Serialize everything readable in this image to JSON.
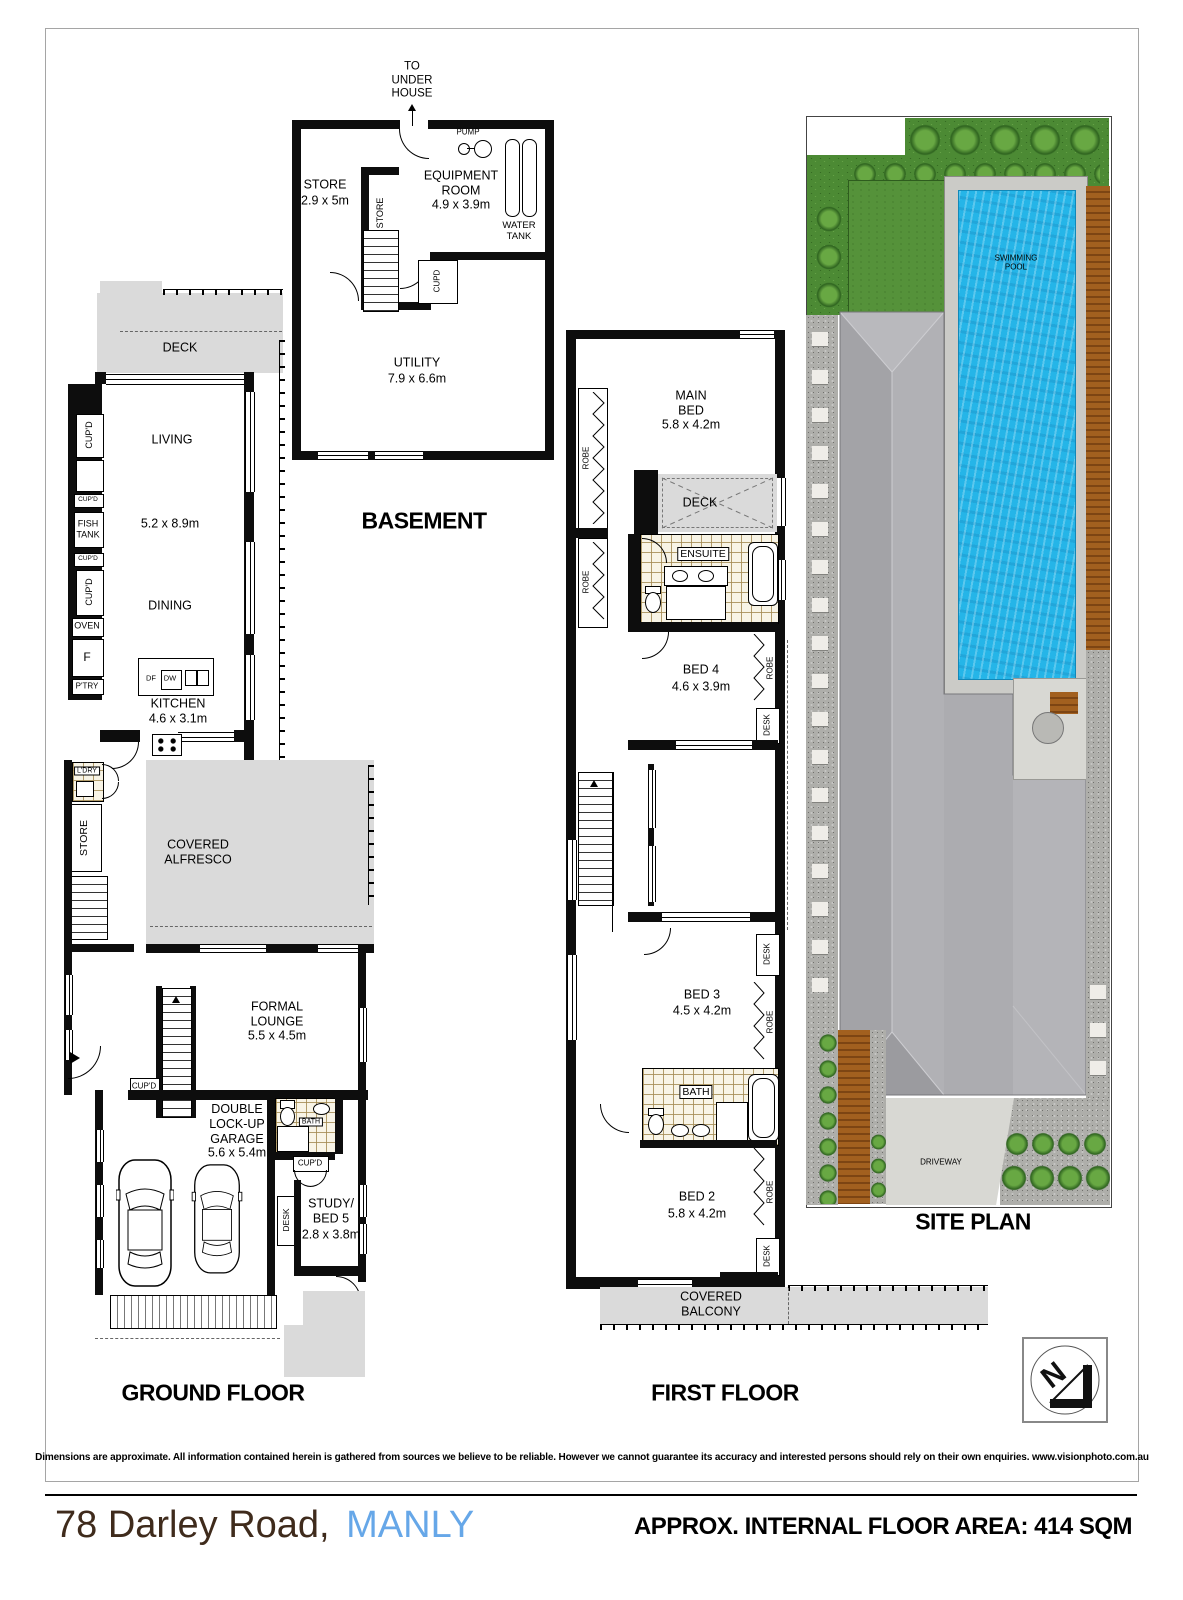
{
  "footer": {
    "address_street": "78 Darley Road,",
    "address_suburb": "MANLY",
    "floor_area": "APPROX. INTERNAL FLOOR AREA: 414 SQM"
  },
  "disclaimer": "Dimensions are approximate. All information contained herein is gathered from sources we believe to be reliable. However we cannot guarantee its accuracy and interested persons should rely on their own enquiries. www.visionphoto.com.au",
  "compass": {
    "n": "N"
  },
  "labels": {
    "robe": "ROBE",
    "desk": "DESK",
    "cupd": "CUP'D",
    "cupd_plain": "CUPD",
    "store": "STORE",
    "bath": "BATH",
    "deck": "DECK",
    "oven": "OVEN",
    "fridge": "F",
    "pantry": "P'TRY",
    "ldry": "L'DRY",
    "fish_tank": "FISH TANK",
    "spa": "SPA"
  },
  "basement": {
    "title": "BASEMENT",
    "to_under_house": "TO UNDER HOUSE",
    "store_name": "STORE",
    "store_dims": "2.9 x 5m",
    "equipment_name": "EQUIPMENT ROOM",
    "equipment_dims": "4.9 x 3.9m",
    "pump": "PUMP",
    "water_tank": "WATER TANK",
    "utility_name": "UTILITY",
    "utility_dims": "7.9 x 6.6m"
  },
  "ground": {
    "title": "GROUND FLOOR",
    "living": "LIVING",
    "living_dining_dims": "5.2 x 8.9m",
    "dining": "DINING",
    "kitchen": "KITCHEN",
    "kitchen_dims": "4.6 x 3.1m",
    "df": "DF",
    "dw": "DW",
    "alfresco": "COVERED ALFRESCO",
    "lounge": "FORMAL LOUNGE",
    "lounge_dims": "5.5 x 4.5m",
    "garage": "DOUBLE LOCK-UP GARAGE",
    "garage_dims": "5.6 x 5.4m",
    "study": "STUDY/ BED 5",
    "study_dims": "2.8 x 3.8m"
  },
  "first": {
    "title": "FIRST FLOOR",
    "main_bed": "MAIN BED",
    "main_bed_dims": "5.8 x 4.2m",
    "ensuite": "ENSUITE",
    "bed4": "BED 4",
    "bed4_dims": "4.6 x 3.9m",
    "bed3": "BED 3",
    "bed3_dims": "4.5 x 4.2m",
    "bed2": "BED 2",
    "bed2_dims": "5.8 x 4.2m",
    "balcony": "COVERED BALCONY"
  },
  "site": {
    "title": "SITE PLAN",
    "pool": "SWIMMING POOL",
    "driveway": "DRIVEWAY"
  }
}
